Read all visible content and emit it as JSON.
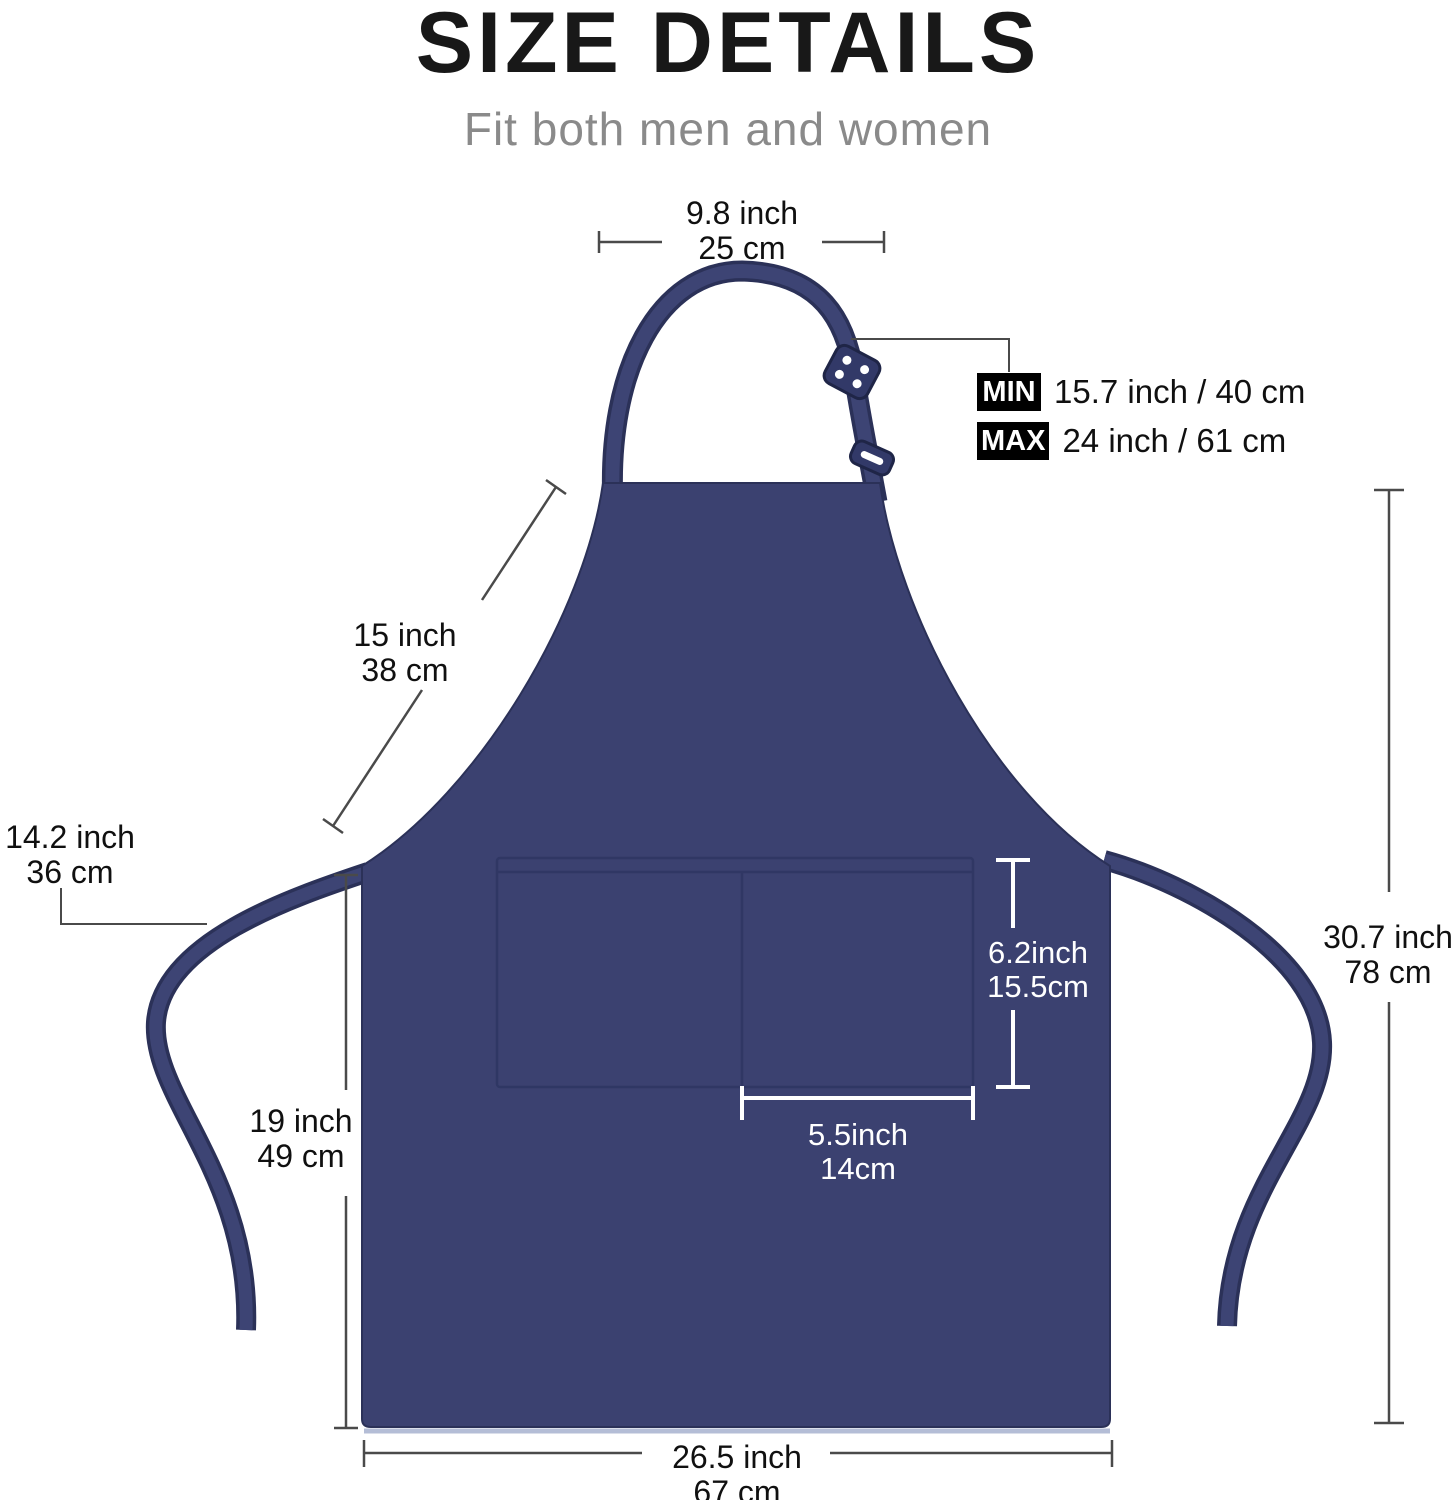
{
  "header": {
    "title": "SIZE DETAILS",
    "subtitle": "Fit both men and women"
  },
  "colors": {
    "apron_navy": "#3b4170",
    "apron_outline": "#2b3158",
    "badge_bg": "#000000",
    "measure_line": "#4a4a4a",
    "pocket_label_text": "#ffffff"
  },
  "labels": {
    "neck_width": {
      "inch": "9.8 inch",
      "cm": "25 cm"
    },
    "neck_strap_min": {
      "badge": "MIN",
      "value": "15.7 inch / 40 cm"
    },
    "neck_strap_max": {
      "badge": "MAX",
      "value": "24 inch / 61 cm"
    },
    "bib_side": {
      "inch": "15 inch",
      "cm": "38 cm"
    },
    "waist_tie": {
      "inch": "14.2 inch",
      "cm": "36 cm"
    },
    "skirt_height": {
      "inch": "19 inch",
      "cm": "49 cm"
    },
    "total_height": {
      "inch": "30.7 inch",
      "cm": "78 cm"
    },
    "pocket_height": {
      "inch": "6.2inch",
      "cm": "15.5cm"
    },
    "pocket_width": {
      "inch": "5.5inch",
      "cm": "14cm"
    },
    "bottom_width": {
      "inch": "26.5 inch",
      "cm": "67 cm"
    }
  }
}
